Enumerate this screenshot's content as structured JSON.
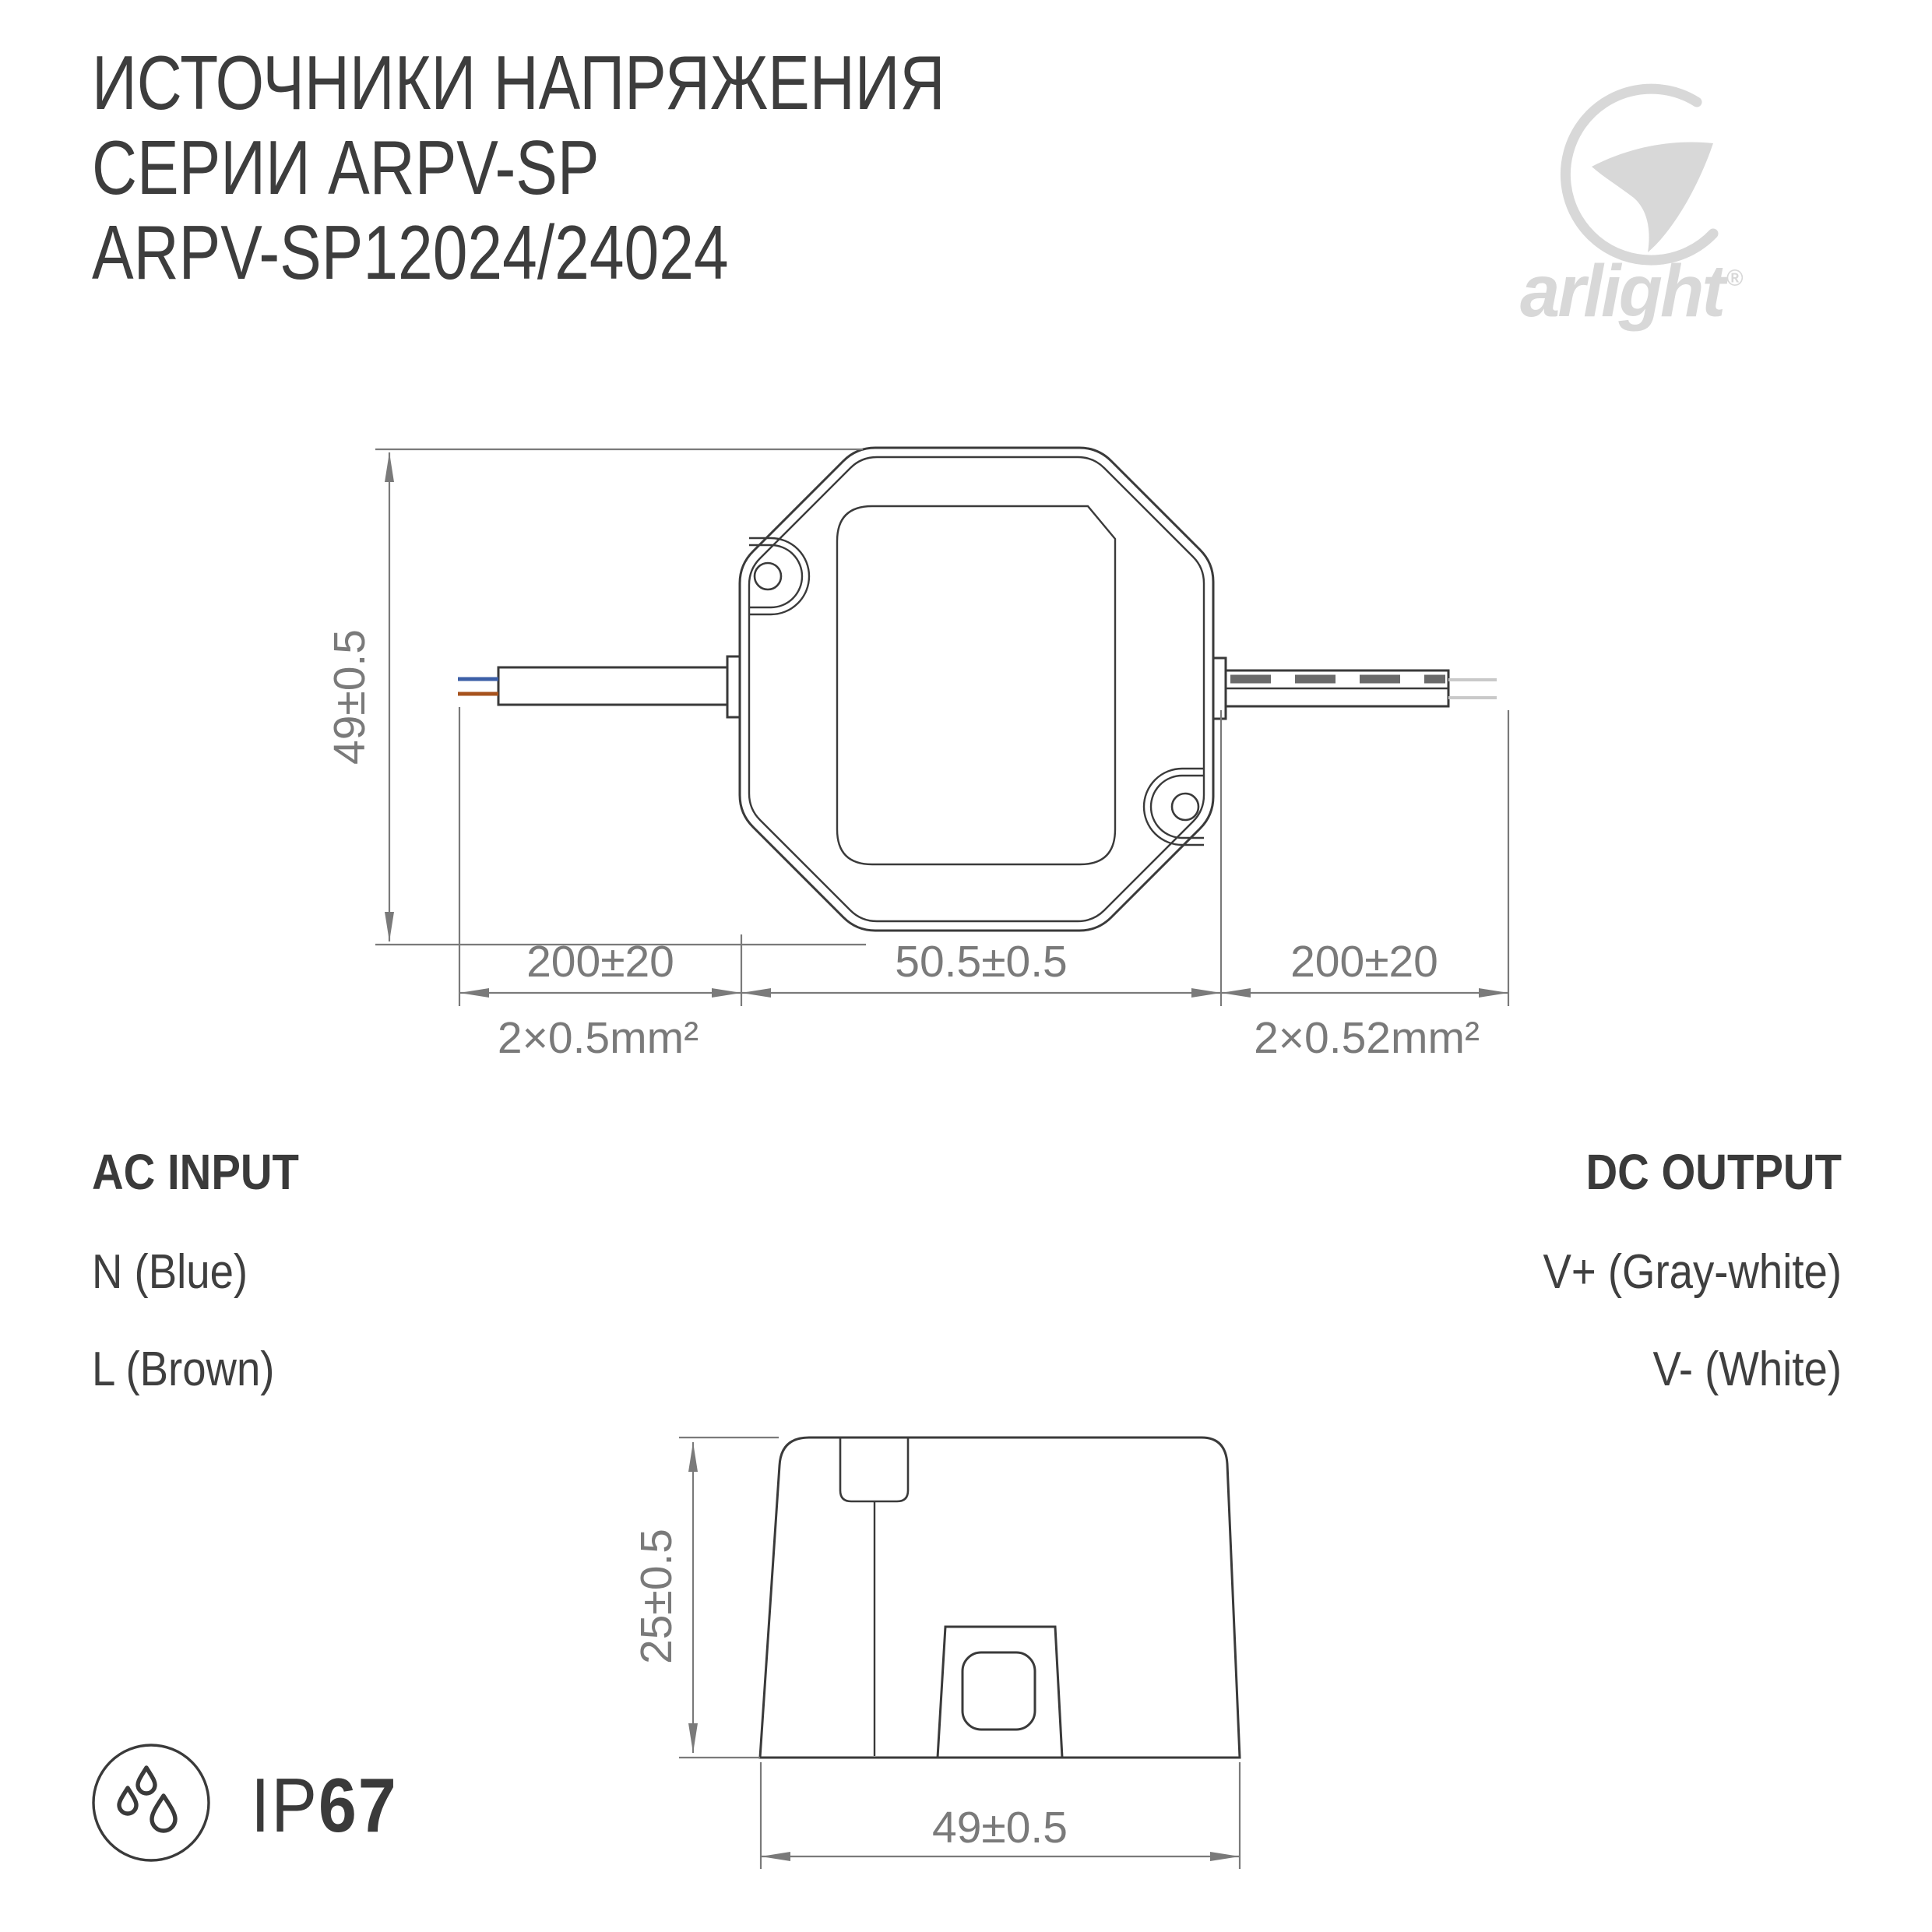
{
  "title": {
    "line1": "ИСТОЧНИКИ НАПРЯЖЕНИЯ",
    "line2": "СЕРИИ ARPV-SP",
    "line3": "ARPV-SP12024/24024"
  },
  "logo": {
    "brand": "arlight",
    "reg": "®"
  },
  "dims": {
    "top": {
      "height": "49±0.5",
      "left_wire": "200±20",
      "body_width": "50.5±0.5",
      "right_wire": "200±20",
      "left_spec": "2×0.5mm²",
      "right_spec": "2×0.52mm²"
    },
    "side": {
      "height": "25±0.5",
      "width": "49±0.5"
    }
  },
  "ac_input": {
    "heading": "AC INPUT",
    "lines": [
      {
        "label": "N (Blue)"
      },
      {
        "label": "L (Brown)"
      }
    ]
  },
  "dc_output": {
    "heading": "DC OUTPUT",
    "lines": [
      {
        "label": "V+ (Gray-white)"
      },
      {
        "label": "V- (White)"
      }
    ]
  },
  "badge": {
    "ip": "IP",
    "rating": "67"
  },
  "colors": {
    "drawing_line": "#3a3a3a",
    "dimension": "#7a7a7a",
    "blue_wire": "#3c5fa7",
    "brown_wire": "#a6521d",
    "gray_core": "#6a6a6a",
    "light_wire": "#c9c9c9",
    "logo": "#d8d8d8",
    "text": "#3d3d3d"
  }
}
